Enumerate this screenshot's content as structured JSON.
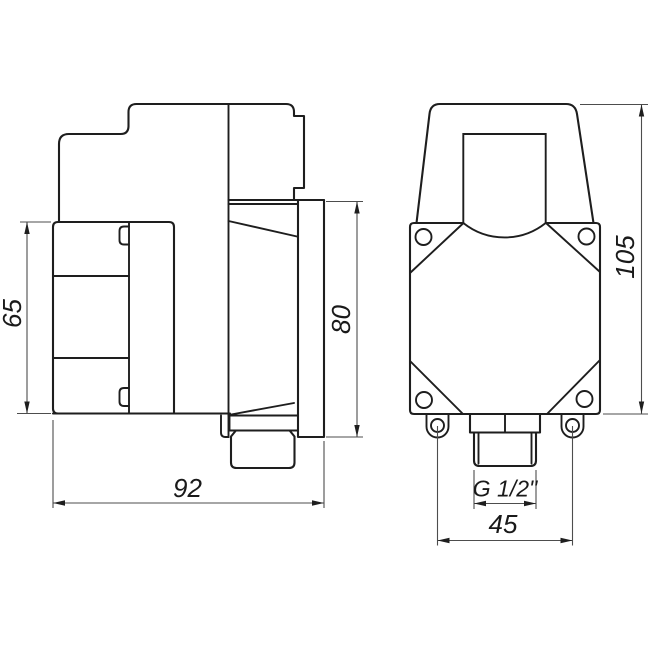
{
  "drawing": {
    "background_color": "#ffffff",
    "line_color": "#1e1e1e",
    "dim_line_color": "#4d4d4d",
    "dimensions": {
      "side_view": {
        "coil_height": "65",
        "overall_width": "92",
        "flange_height": "80"
      },
      "front_view": {
        "overall_height": "105",
        "mount_hole_spacing": "45",
        "thread": "G 1/2\""
      }
    }
  }
}
